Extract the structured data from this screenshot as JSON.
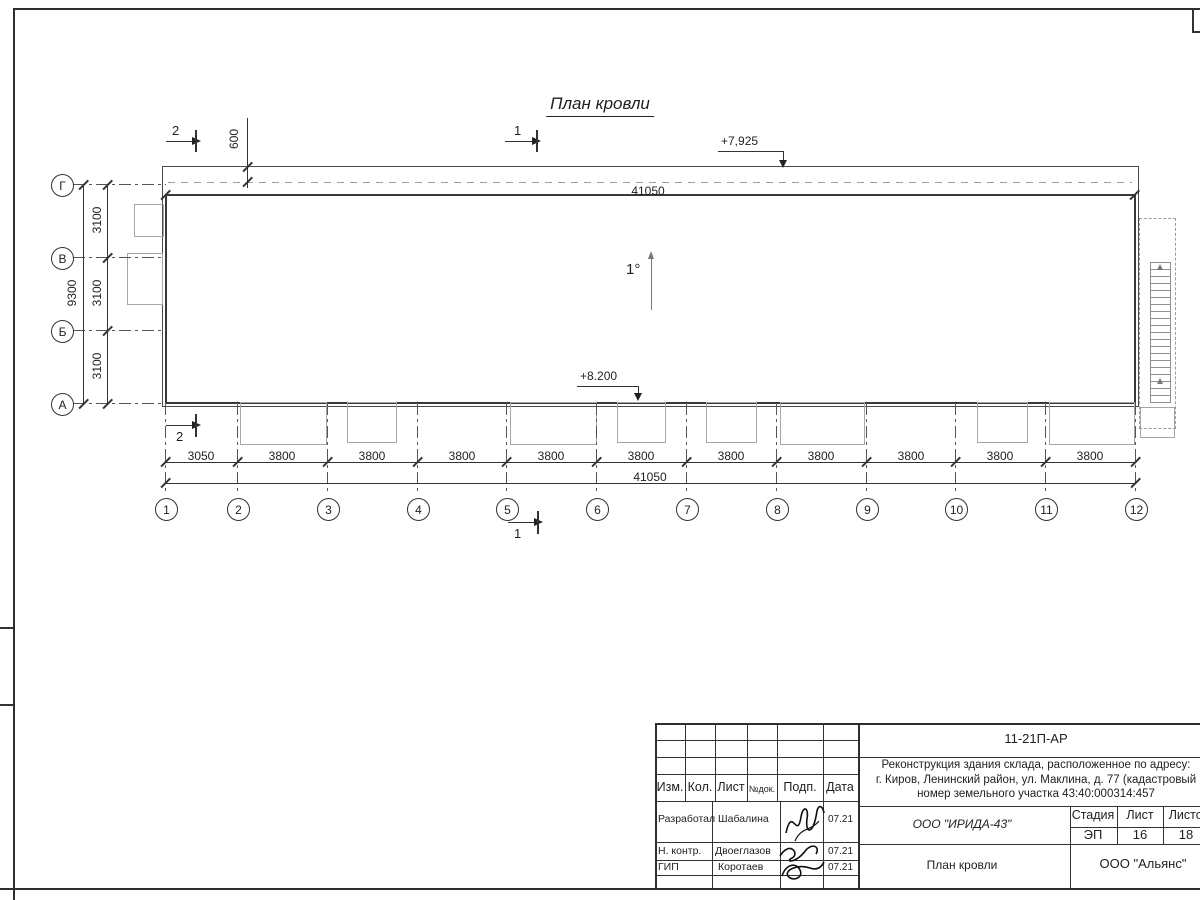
{
  "colors": {
    "ink": "#1f1f1f",
    "light_gray": "#a6a6a6"
  },
  "drawing": {
    "title": "План кровли",
    "slope": "1°",
    "elevation_roof": "+7,925",
    "elevation_eave": "+8.200",
    "overhang_dim": "600",
    "total_dim": "41050",
    "left_dims": {
      "total": "9300",
      "segments": [
        "3100",
        "3100",
        "3100"
      ]
    },
    "bottom_dims": {
      "total": "41050",
      "segments": [
        "3050",
        "3800",
        "3800",
        "3800",
        "3800",
        "3800",
        "3800",
        "3800",
        "3800",
        "3800",
        "3800"
      ]
    },
    "axes_cols": [
      "1",
      "2",
      "3",
      "4",
      "5",
      "6",
      "7",
      "8",
      "9",
      "10",
      "11",
      "12"
    ],
    "axes_rows": [
      "Г",
      "В",
      "Б",
      "А"
    ],
    "sections": {
      "one": "1",
      "two": "2"
    }
  },
  "titleblock": {
    "doc_number": "11-21П-АР",
    "project_lines": [
      "Реконструкция здания склада, расположенное по адресу:",
      "г. Киров, Ленинский район, ул. Маклина, д. 77 (кадастровый",
      "номер земельного участка 43:40:000314:457"
    ],
    "columns": [
      "Изм.",
      "Кол.",
      "Лист",
      "№док.",
      "Подп.",
      "Дата"
    ],
    "rows": [
      {
        "role": "Разработал",
        "name": "Шабалина",
        "date": "07.21"
      },
      {
        "role": "Н. контр.",
        "name": "Двоеглазов",
        "date": "07.21"
      },
      {
        "role": "ГИП",
        "name": "Коротаев",
        "date": "07.21"
      }
    ],
    "org": "ООО \"ИРИДА-43\"",
    "sheet_name": "План кровли",
    "stage_header": [
      "Стадия",
      "Лист",
      "Листов"
    ],
    "stage_values": [
      "ЭП",
      "16",
      "18"
    ],
    "company": "ООО \"Альянс\""
  }
}
